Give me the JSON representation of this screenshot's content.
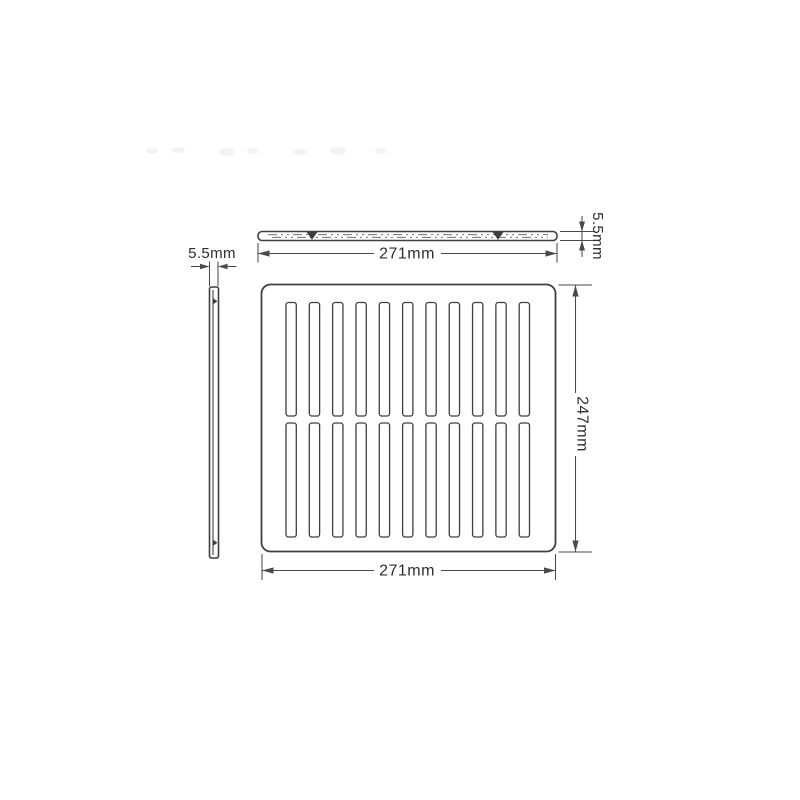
{
  "colors": {
    "background": "#ffffff",
    "line": "#3f3f3f",
    "dimension_line": "#4a4a4a",
    "text": "#2e2e2e"
  },
  "drawing": {
    "type": "technical-drawing",
    "part": "ventilation-grille-plate",
    "front_view": {
      "slot_columns": 11,
      "slot_rows": 2
    },
    "dimensions": {
      "top_width": {
        "label": "271mm"
      },
      "bottom_width": {
        "label": "271mm"
      },
      "height": {
        "label": "247mm"
      },
      "thickness_side": {
        "label": "5.5mm"
      },
      "thickness_top": {
        "label": "5.5mm"
      }
    }
  }
}
